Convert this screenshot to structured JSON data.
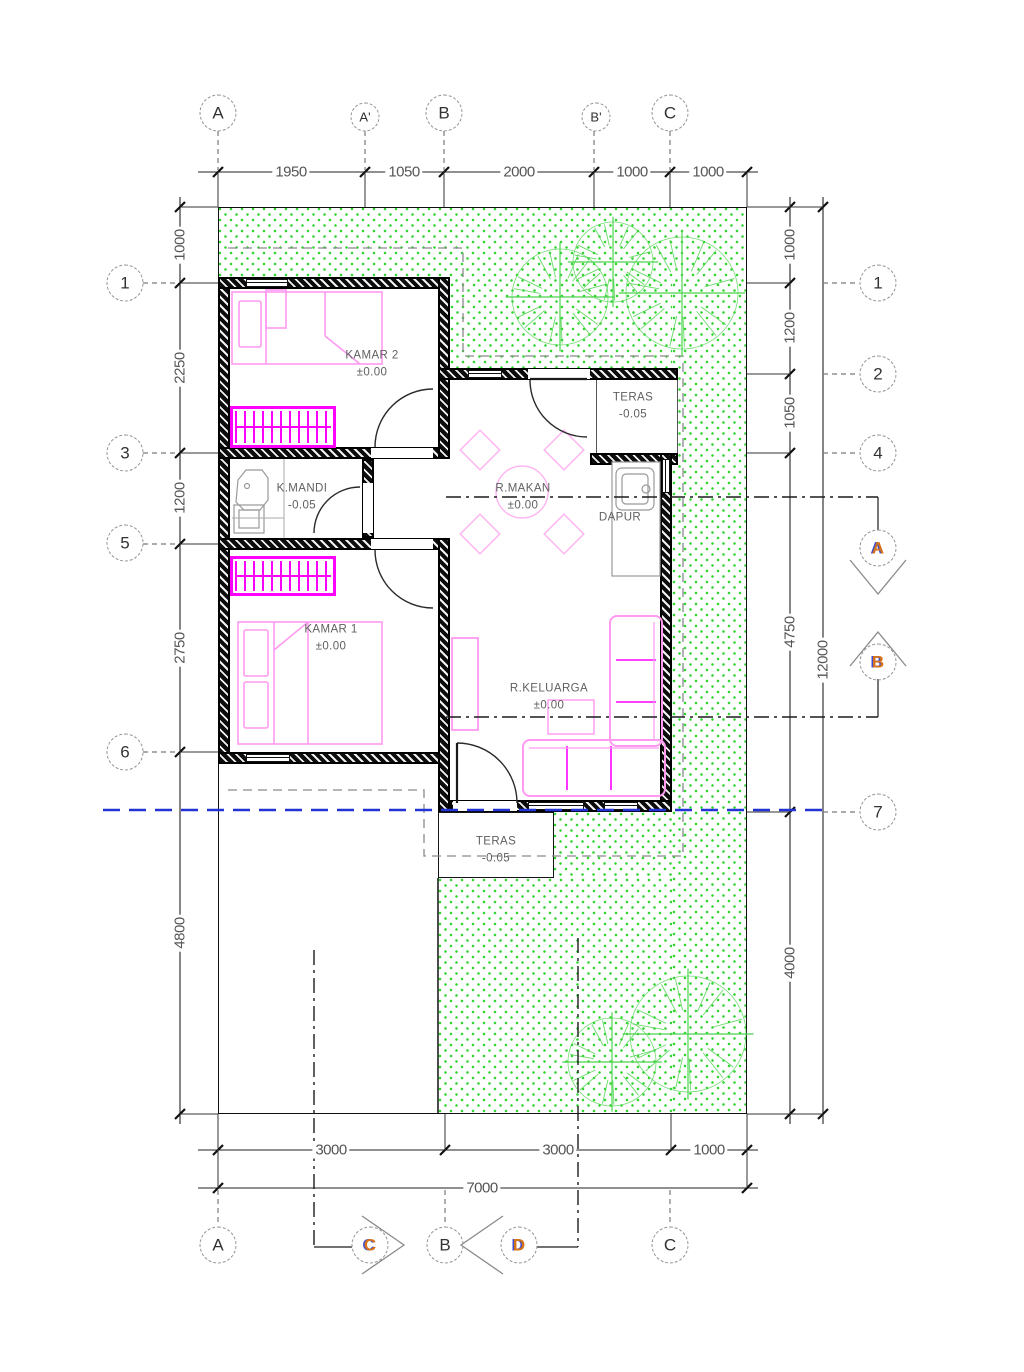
{
  "rooms": {
    "kamar2": {
      "name": "KAMAR 2",
      "level": "±0.00"
    },
    "teras_atas": {
      "name": "TERAS",
      "level": "-0.05"
    },
    "rmakan": {
      "name": "R.MAKAN",
      "level": "±0.00"
    },
    "dapur": {
      "name": "DAPUR",
      "level": ""
    },
    "kmandi": {
      "name": "K.MANDI",
      "level": "-0.05"
    },
    "kamar1": {
      "name": "KAMAR 1",
      "level": "±0.00"
    },
    "rkeluarga": {
      "name": "R.KELUARGA",
      "level": "±0.00"
    },
    "teras_bawah": {
      "name": "TERAS",
      "level": "-0.05"
    }
  },
  "grid": {
    "top": [
      "A",
      "A'",
      "B",
      "B'",
      "C"
    ],
    "left": [
      "1",
      "3",
      "5",
      "6"
    ],
    "right": [
      "1",
      "2",
      "4",
      "7"
    ],
    "bottom": [
      "A",
      "B",
      "C"
    ]
  },
  "sections": {
    "a": "A",
    "b": "B",
    "c": "C",
    "d": "D"
  },
  "dimensions": {
    "top": [
      "1950",
      "1050",
      "2000",
      "1000",
      "1000"
    ],
    "left": [
      "1000",
      "2250",
      "1200",
      "2750",
      "4800"
    ],
    "right": [
      "1000",
      "1200",
      "1050",
      "4750",
      "4000"
    ],
    "right_total": "12000",
    "bottom": [
      "3000",
      "3000",
      "1000"
    ],
    "bottom_total": "7000"
  },
  "colors": {
    "magenta": "#ff00ff",
    "furniture_pink": "#ff9af0",
    "soft_pink": "#ffb6f2",
    "hatch_green": "#35d435",
    "tree_green": "#4bd44b",
    "boundary_blue": "#2433d6",
    "section_letter_orange": "#d4731c",
    "drawing_gray": "#5a5a5a"
  }
}
